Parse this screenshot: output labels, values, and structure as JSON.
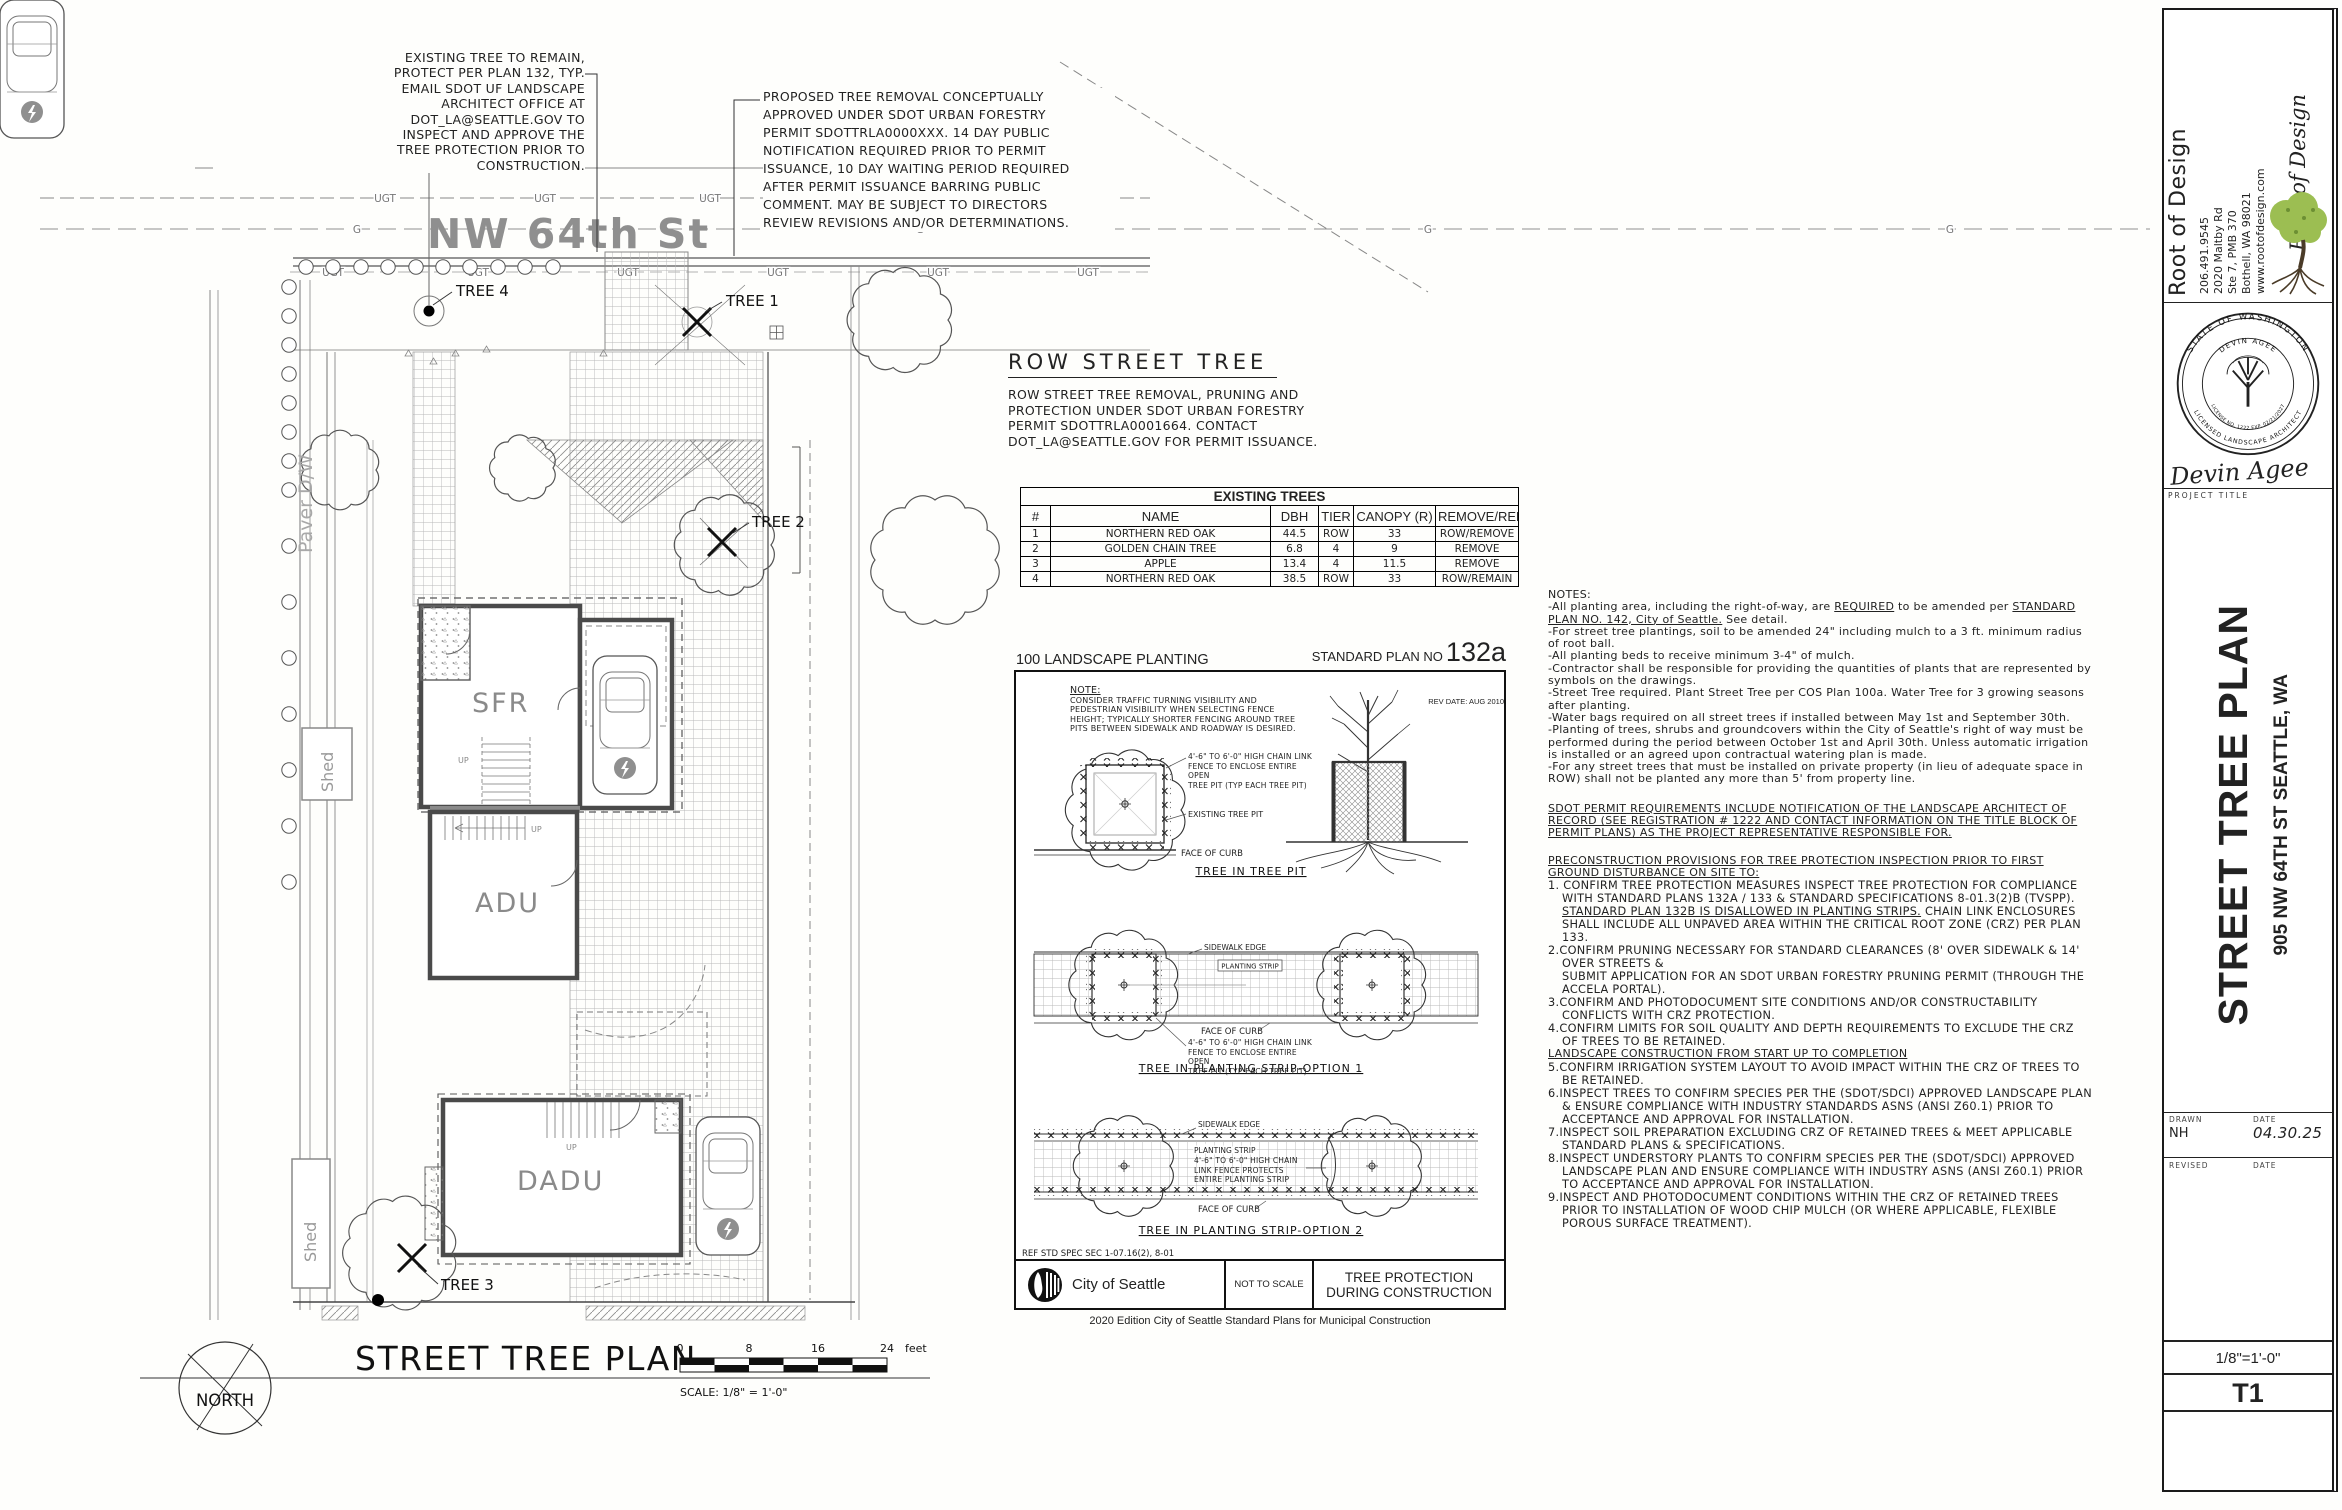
{
  "site": {
    "street_name": "NW 64th St",
    "note_existing_tree": "EXISTING TREE TO REMAIN,\nPROTECT PER PLAN 132, TYP.\nEMAIL SDOT UF LANDSCAPE\nARCHITECT OFFICE AT\nDOT_LA@SEATTLE.GOV TO\nINSPECT AND APPROVE THE\nTREE PROTECTION PRIOR TO\nCONSTRUCTION.",
    "note_proposed_removal": "PROPOSED TREE REMOVAL CONCEPTUALLY\nAPPROVED UNDER SDOT URBAN FORESTRY\nPERMIT SDOTTRLA0000XXX. 14 DAY PUBLIC\nNOTIFICATION REQUIRED PRIOR TO PERMIT\nISSUANCE, 10 DAY WAITING PERIOD REQUIRED\nAFTER PERMIT ISSUANCE BARRING PUBLIC\nCOMMENT. MAY BE SUBJECT TO DIRECTORS\nREVIEW REVISIONS AND/OR DETERMINATIONS.",
    "labels": {
      "tree1": "TREE 1",
      "tree2": "TREE 2",
      "tree3": "TREE 3",
      "tree4": "TREE 4",
      "sfr": "SFR",
      "adu": "ADU",
      "dadu": "DADU",
      "shed": "Shed",
      "paver": "Paver D/W",
      "ugt": "UGT",
      "g": "G",
      "up": "UP"
    },
    "plan_title": "STREET TREE PLAN",
    "north_label": "NORTH",
    "scale_text": "SCALE: 1/8\" = 1'-0\"",
    "scale_ticks": [
      "0",
      "8",
      "16",
      "24"
    ],
    "scale_unit": "feet"
  },
  "row_street_tree": {
    "heading": "ROW STREET TREE",
    "body": "ROW STREET TREE REMOVAL, PRUNING AND\nPROTECTION UNDER SDOT URBAN FORESTRY\nPERMIT SDOTTRLA0001664. CONTACT\nDOT_LA@SEATTLE.GOV FOR PERMIT ISSUANCE."
  },
  "existing_trees_table": {
    "title": "EXISTING TREES",
    "columns": [
      "#",
      "NAME",
      "DBH",
      "TIER",
      "CANOPY (R)",
      "REMOVE/REMAIN"
    ],
    "rows": [
      [
        "1",
        "NORTHERN RED OAK",
        "44.5",
        "ROW",
        "33",
        "ROW/REMOVE"
      ],
      [
        "2",
        "GOLDEN CHAIN TREE",
        "6.8",
        "4",
        "9",
        "REMOVE"
      ],
      [
        "3",
        "APPLE",
        "13.4",
        "4",
        "11.5",
        "REMOVE"
      ],
      [
        "4",
        "NORTHERN RED OAK",
        "38.5",
        "ROW",
        "33",
        "ROW/REMAIN"
      ]
    ]
  },
  "standard_plan": {
    "left_header": "100 LANDSCAPE PLANTING",
    "right_header": "STANDARD PLAN NO",
    "plan_number": "132a",
    "rev_date": "REV DATE: AUG 2010",
    "note_heading": "NOTE:",
    "note_body": "CONSIDER TRAFFIC TURNING VISIBILITY AND\nPEDESTRIAN VISIBILITY WHEN SELECTING FENCE\nHEIGHT; TYPICALLY SHORTER FENCING AROUND TREE\nPITS BETWEEN SIDEWALK AND ROADWAY IS DESIRED.",
    "fence_note": "4'-6\" TO 6'-0\" HIGH CHAIN LINK\nFENCE TO ENCLOSE ENTIRE OPEN\nTREE PIT (TYP EACH TREE PIT)",
    "fence_note2": "4'-6\" TO 6'-0\" HIGH CHAIN\nLINK FENCE PROTECTS\nENTIRE PLANTING STRIP",
    "existing_tree_pit": "EXISTING TREE PIT",
    "face_of_curb": "FACE OF CURB",
    "sidewalk_edge": "SIDEWALK EDGE",
    "planting_strip": "PLANTING STRIP",
    "detail1": "TREE IN TREE PIT",
    "detail2": "TREE IN PLANTING STRIP-OPTION 1",
    "detail3": "TREE IN PLANTING STRIP-OPTION 2",
    "ref_spec": "REF STD SPEC SEC 1-07.16(2), 8-01",
    "agency": "City of Seattle",
    "not_to_scale": "NOT TO SCALE",
    "plan_title": "TREE PROTECTION\nDURING CONSTRUCTION",
    "caption": "2020 Edition City of Seattle Standard Plans for Municipal Construction"
  },
  "notes": {
    "heading": "NOTES:",
    "items": [
      "-All planting area, including the right-of-way, are __REQUIRED__ to be amended per __STANDARD PLAN NO. 142, City of Seattle.__  See detail.",
      "-For street tree plantings, soil to be amended 24\" including mulch to a 3 ft. minimum radius of root ball.",
      "-All planting beds to receive minimum 3-4\" of mulch.",
      "-Contractor shall be responsible for providing the quantities of plants that are represented by symbols on the drawings.",
      "-Street Tree required. Plant Street Tree per COS Plan 100a. Water Tree for 3 growing seasons after planting.",
      "-Water bags required on all street trees if installed between May 1st and September 30th.",
      "-Planting of trees, shrubs and groundcovers within the City of Seattle's right of way must be performed during the period between October 1st and April 30th.  Unless automatic irrigation is installed or an agreed upon contractual watering plan is made.",
      "-For any street trees that must be installed on private property (in lieu of adequate space in ROW) shall not be planted any more than 5' from property line."
    ],
    "permit_para": "SDOT PERMIT REQUIREMENTS INCLUDE NOTIFICATION OF THE LANDSCAPE ARCHITECT OF RECORD (SEE REGISTRATION # 1222 AND CONTACT INFORMATION ON THE TITLE BLOCK OF PERMIT PLANS) AS THE PROJECT REPRESENTATIVE RESPONSIBLE FOR.",
    "precon_heading": "PRECONSTRUCTION PROVISIONS FOR TREE PROTECTION INSPECTION PRIOR TO FIRST GROUND DISTURBANCE ON SITE TO:",
    "provisions_1": [
      "1. CONFIRM TREE PROTECTION MEASURES INSPECT TREE PROTECTION FOR COMPLIANCE WITH STANDARD PLANS 132A / 133 & STANDARD SPECIFICATIONS 8-01.3(2)B (TVSPP). __STANDARD PLAN 132B IS DISALLOWED IN PLANTING STRIPS.__ CHAIN LINK ENCLOSURES SHALL INCLUDE ALL UNPAVED AREA WITHIN THE CRITICAL ROOT ZONE (CRZ) PER PLAN 133.",
      "2.CONFIRM PRUNING NECESSARY FOR STANDARD CLEARANCES (8' OVER SIDEWALK & 14' OVER STREETS &\nSUBMIT APPLICATION FOR AN SDOT URBAN FORESTRY PRUNING PERMIT (THROUGH THE ACCELA PORTAL).",
      "3.CONFIRM AND PHOTODOCUMENT SITE CONDITIONS AND/OR CONSTRUCTABILITY CONFLICTS WITH CRZ PROTECTION.",
      "4.CONFIRM LIMITS FOR SOIL QUALITY AND DEPTH REQUIREMENTS TO EXCLUDE THE CRZ OF TREES TO BE RETAINED."
    ],
    "landscape_heading": "LANDSCAPE CONSTRUCTION FROM START UP TO COMPLETION",
    "provisions_2": [
      "5.CONFIRM IRRIGATION SYSTEM LAYOUT TO AVOID IMPACT WITHIN THE CRZ OF TREES TO BE RETAINED.",
      "6.INSPECT TREES TO CONFIRM SPECIES PER THE (SDOT/SDCI) APPROVED LANDSCAPE PLAN & ENSURE COMPLIANCE WITH INDUSTRY STANDARDS ASNS (ANSI Z60.1) PRIOR TO ACCEPTANCE AND APPROVAL FOR INSTALLATION.",
      "7.INSPECT SOIL PREPARATION EXCLUDING CRZ OF RETAINED TREES & MEET APPLICABLE STANDARD PLANS & SPECIFICATIONS.",
      "8.INSPECT UNDERSTORY PLANTS TO CONFIRM SPECIES PER THE (SDOT/SDCI) APPROVED LANDSCAPE PLAN AND ENSURE COMPLIANCE WITH INDUSTRY ASNS (ANSI Z60.1) PRIOR TO ACCEPTANCE AND APPROVAL FOR INSTALLATION.",
      "9.INSPECT AND PHOTODOCUMENT CONDITIONS WITHIN THE CRZ OF RETAINED TREES PRIOR TO INSTALLATION OF WOOD CHIP MULCH (OR WHERE APPLICABLE, FLEXIBLE POROUS SURFACE TREATMENT)."
    ]
  },
  "title_block": {
    "firm": "Root of Design",
    "contact": [
      "206.491.9545",
      "2020 Maltby Rd",
      "Ste 7, PMB 370",
      "Bothell, WA 98021",
      "www.rootofdesign.com"
    ],
    "logo_script": "Root of Design",
    "stamp": {
      "top": "STATE OF WASHINGTON",
      "bottom": "LICENSED LANDSCAPE ARCHITECT",
      "name": "DEVIN AGEE",
      "license": "LICENSE NO. 1222  EXP. 02/21/2027"
    },
    "signature": "Devin Agee",
    "project_title_label": "PROJECT TITLE",
    "project_title": "STREET TREE PLAN",
    "project_address": "905 NW 64TH ST SEATTLE, WA",
    "drawn_label": "DRAWN",
    "drawn": "NH",
    "date_label": "DATE",
    "date": "04.30.25",
    "revised_label": "REVISED",
    "revised_date_label": "DATE",
    "scale": "1/8\"=1'-0\"",
    "sheet": "T1"
  },
  "colors": {
    "street_gray": "#8f8f8f",
    "canopy_green": "#9cbe52",
    "trunk_brown": "#4a3b28",
    "line_black": "#1a1a1a"
  }
}
